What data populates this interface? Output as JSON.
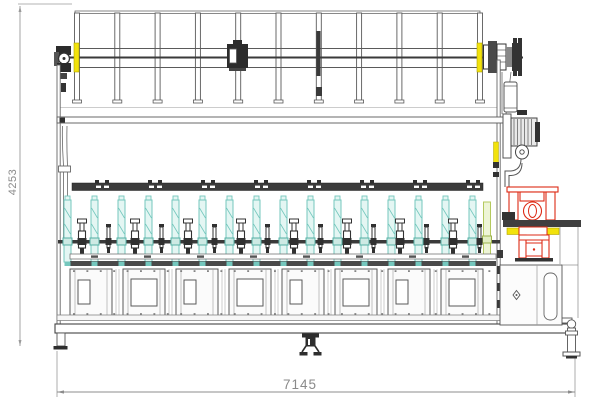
{
  "drawing": {
    "type": "machine-side-elevation-cad",
    "dimensions": {
      "width_label": "7145",
      "height_label": "4253"
    },
    "colors": {
      "line": "#5a5a5a",
      "line_dark": "#333333",
      "fill_dark": "#303030",
      "yellow": "#f2e20c",
      "yellow_edge": "#b0a400",
      "teal": "#74c7bd",
      "teal_fill": "#e4f6f3",
      "teal_node": "#cdeae4",
      "teal_node_edge": "#55b0a5",
      "green": "#b4c95e",
      "green_fill": "#eef5d6",
      "red": "#dd2a14",
      "dim_line": "#9a9a9a",
      "dim_text": "#8a8a8a",
      "light_fill": "#f7f7f7"
    },
    "structure": {
      "posts": {
        "count": 11,
        "x_start": 77,
        "spacing": 40.3
      },
      "tubes": {
        "count": 16,
        "x_start": 67.5,
        "spacing": 27
      },
      "clamps": {
        "count": 8,
        "x_start": 82,
        "spacing": 53
      },
      "pins": {
        "count": 8,
        "x_start": 108.5,
        "spacing": 53
      },
      "cabinets": {
        "count": 8,
        "x_start": 70,
        "spacing": 53,
        "width": 42
      },
      "rail_dashes": {
        "count": 8,
        "x_start": 96,
        "spacing": 53
      }
    }
  }
}
